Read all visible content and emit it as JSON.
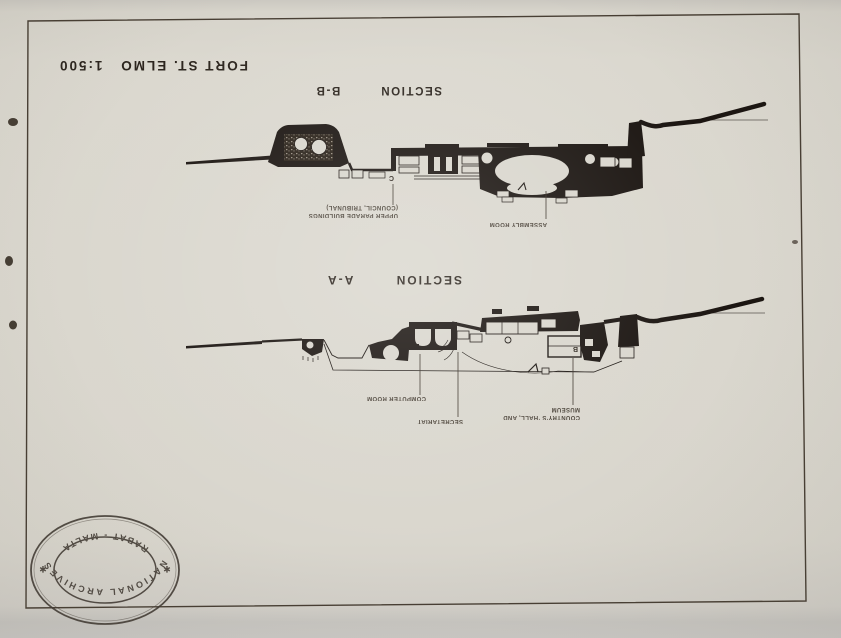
{
  "page": {
    "title": "FORT ST. ELMO",
    "scale": "1:500"
  },
  "section_b": {
    "title_word": "SECTION",
    "title_id": "B-B",
    "label_upper_parade_1": "UPPER PARADE BUILDINGS",
    "label_upper_parade_2": "(COUNCIL, TRIBUNAL)",
    "label_assembly": "ASSEMBLY ROOM",
    "marker_c": "C"
  },
  "section_a": {
    "title_word": "SECTION",
    "title_id": "A-A",
    "label_computer": "COMPUTER ROOM",
    "label_secretariat": "SECRETARIAT",
    "label_museum_1": "COUNTRY'S 'HALL, AND",
    "label_museum_2": "MUSEUM",
    "marker_b": "B"
  },
  "stamp": {
    "top_text": "NATIONAL ARCHIVES",
    "bottom_text": "RABAT - MALTA",
    "star": "✱"
  },
  "colors": {
    "paper": "#d9d6cd",
    "ink": "#1b1511",
    "stamp_ink": "#3f3831"
  }
}
